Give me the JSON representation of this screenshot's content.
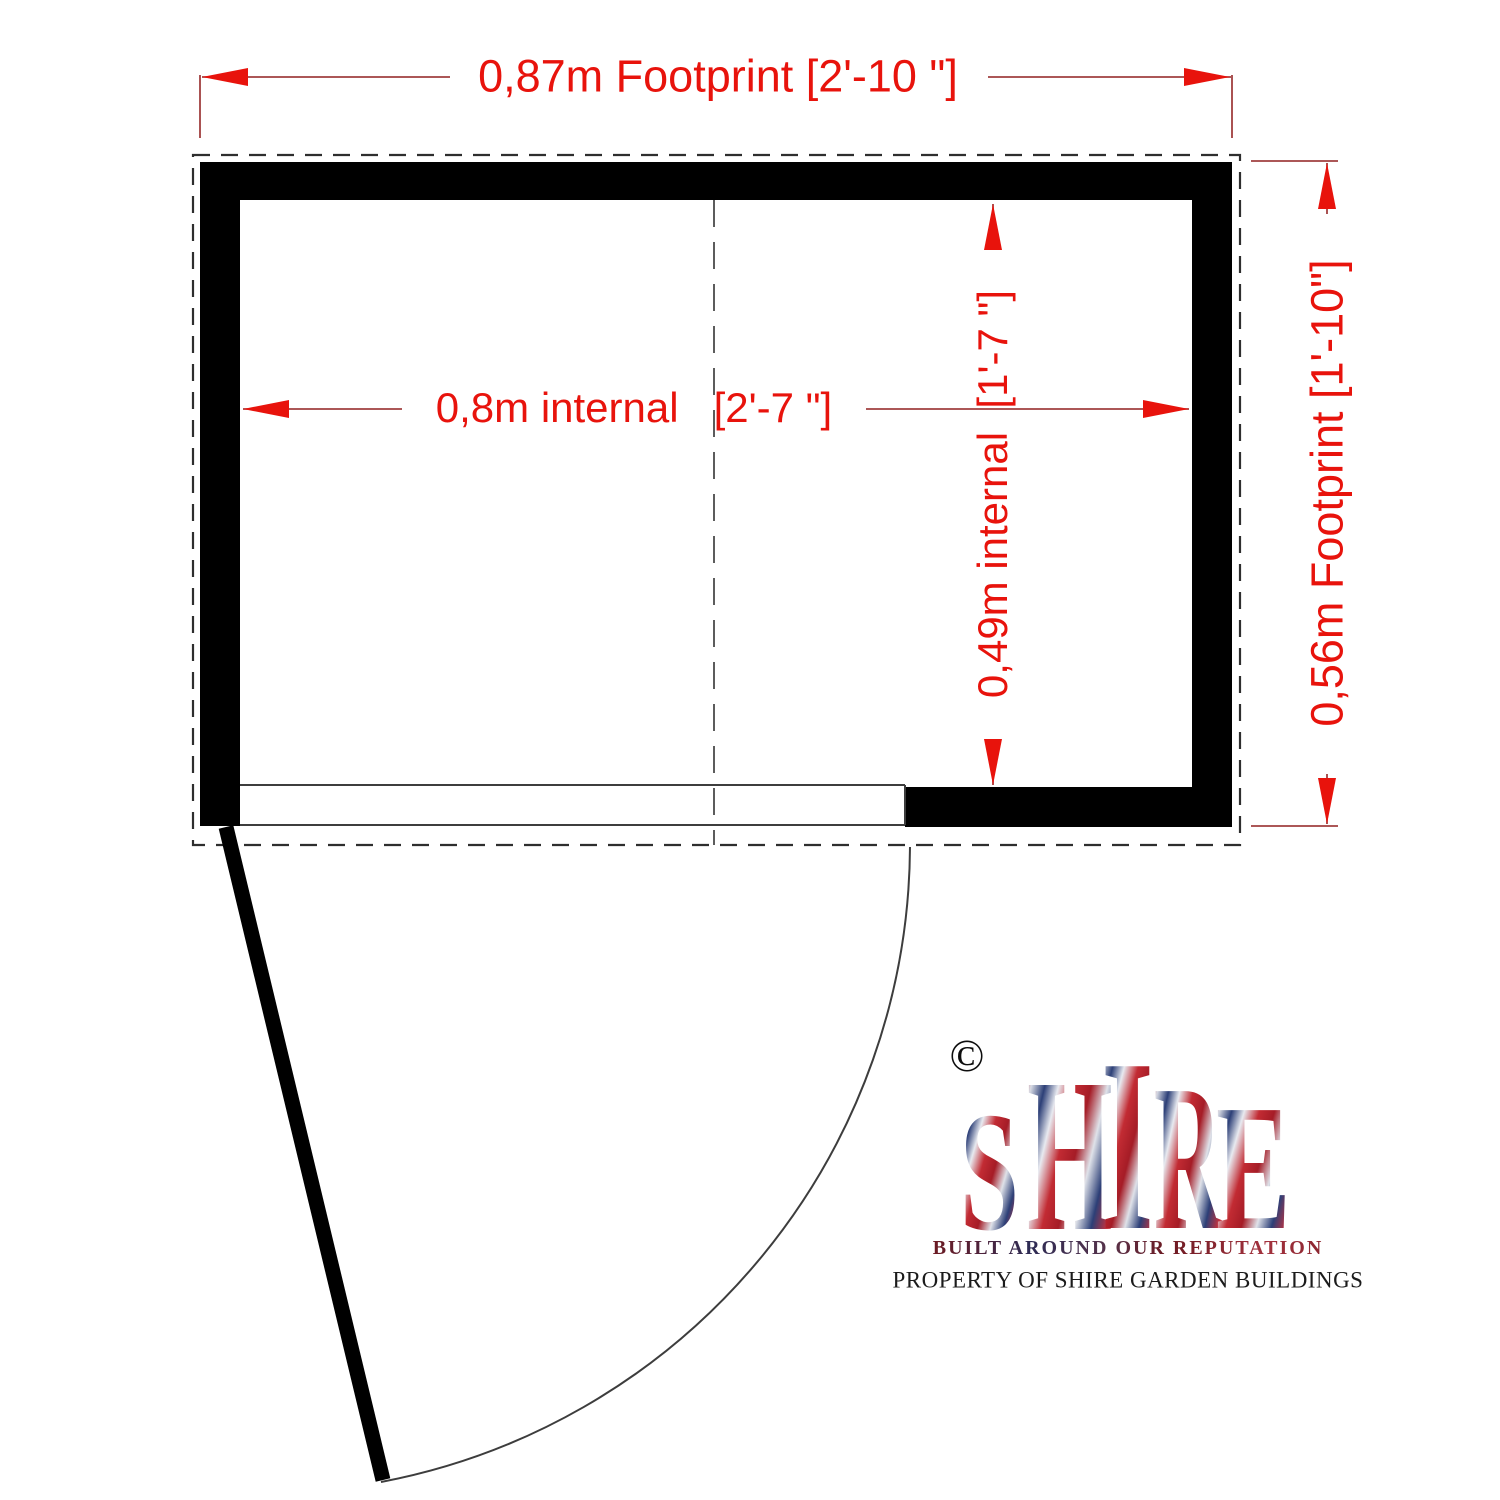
{
  "plan": {
    "dimensions": {
      "top_footprint": "0,87m Footprint [2'-10 \"]",
      "right_footprint": "0,56m Footprint [1'-10\"]",
      "internal_width": "0,8m internal   [2'-7 \"]",
      "internal_depth": "0,49m internal  [1'-7 \"]"
    }
  },
  "logo": {
    "copyright_symbol": "©",
    "brand_letters": [
      "S",
      "H",
      "I",
      "R",
      "E"
    ],
    "tagline": "BUILT AROUND OUR REPUTATION",
    "property_notice": "PROPERTY OF SHIRE GARDEN BUILDINGS"
  },
  "colors": {
    "dimension_text_red": "#e8130c",
    "dimension_line_red": "#a13f3f",
    "wall_black": "#000000",
    "outline_grey": "#2e2e2e",
    "flag_red": "#c22b33",
    "flag_blue": "#2c3f77"
  }
}
